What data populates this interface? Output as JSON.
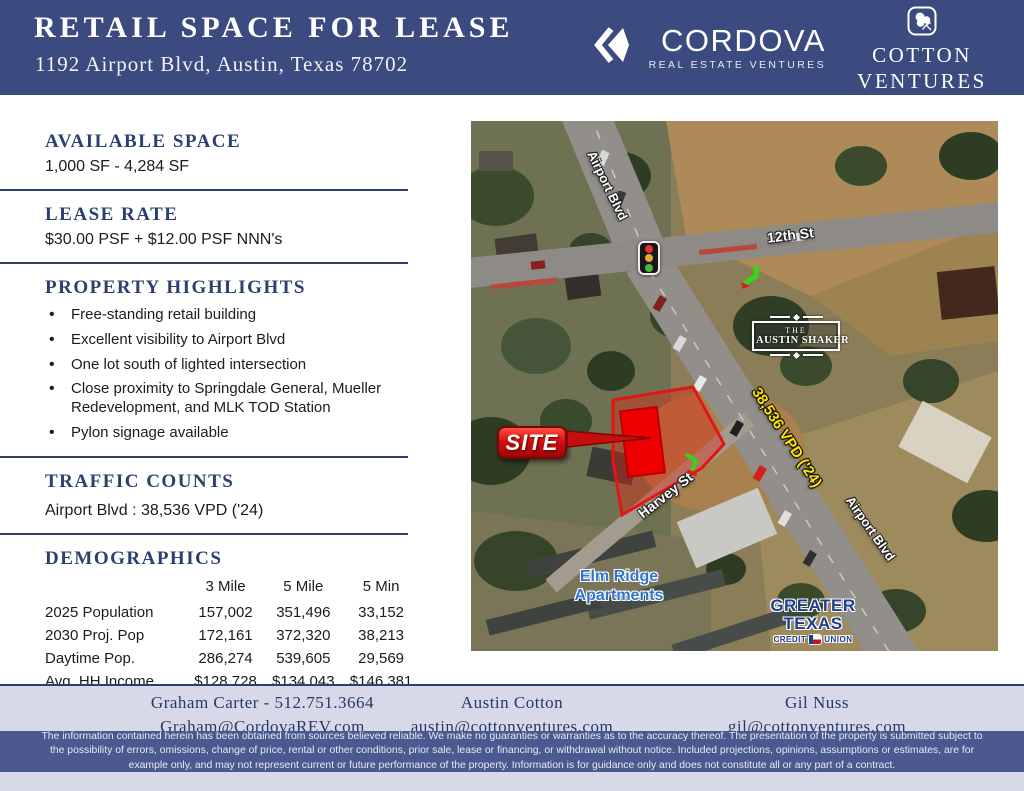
{
  "header": {
    "title": "RETAIL SPACE FOR LEASE",
    "subtitle": "1192 Airport Blvd, Austin, Texas 78702",
    "cordova_name": "CORDOVA",
    "cordova_tagline": "REAL ESTATE VENTURES",
    "cotton_line1": "COTTON",
    "cotton_line2": "VENTURES"
  },
  "colors": {
    "header_navy": "#3b4a7f",
    "accent_navy": "#2c406f",
    "band_lavender": "#d8d9e8",
    "disclaimer_navy": "#4c5890",
    "site_red": "#d61010",
    "vpd_yellow": "#ffe300"
  },
  "available_space": {
    "heading": "AVAILABLE SPACE",
    "value": "1,000 SF - 4,284 SF"
  },
  "lease_rate": {
    "heading": "LEASE RATE",
    "value": "$30.00 PSF + $12.00 PSF NNN's"
  },
  "highlights": {
    "heading": "PROPERTY HIGHLIGHTS",
    "items": [
      "Free-standing retail building",
      "Excellent visibility to Airport Blvd",
      "One lot south of lighted intersection",
      "Close proximity to Springdale General, Mueller Redevelopment, and MLK TOD Station",
      "Pylon signage available"
    ]
  },
  "traffic_counts": {
    "heading": "TRAFFIC COUNTS",
    "value": "Airport Blvd : 38,536 VPD ('24)"
  },
  "demographics": {
    "heading": "DEMOGRAPHICS",
    "columns": [
      "3 Mile",
      "5 Mile",
      "5 Min"
    ],
    "rows": [
      {
        "label": "2025 Population",
        "values": [
          "157,002",
          "351,496",
          "33,152"
        ]
      },
      {
        "label": "2030 Proj. Pop",
        "values": [
          "172,161",
          "372,320",
          "38,213"
        ]
      },
      {
        "label": "Daytime Pop.",
        "values": [
          "286,274",
          "539,605",
          "29,569"
        ]
      },
      {
        "label": "Avg. HH Income",
        "values": [
          "$128,728",
          "$134,043",
          "$146,381"
        ]
      }
    ]
  },
  "map": {
    "street_airport_top": "Airport Blvd",
    "street_12th": "12th St",
    "street_harvey": "Harvey St",
    "street_airport_bottom": "Airport Blvd",
    "site_label": "SITE",
    "vpd_label": "38,536 VPD ('24)",
    "shaker_the": "THE",
    "shaker_name": "AUSTIN SHAKER",
    "elm_line1": "Elm Ridge",
    "elm_line2": "Apartments",
    "gtcu_line1": "GREATER",
    "gtcu_line2": "TEXAS",
    "gtcu_credit": "CREDIT",
    "gtcu_union": "UNION"
  },
  "footer": {
    "contacts": [
      {
        "line1": "Graham Carter - 512.751.3664",
        "line2": "Graham@CordovaREV.com"
      },
      {
        "line1": "Austin Cotton",
        "line2": "austin@cottonventures.com"
      },
      {
        "line1": "Gil Nuss",
        "line2": "gil@cottonventures.com"
      }
    ],
    "disclaimer": "The information contained herein has been obtained from sources believed reliable. We make no guaranties or warranties as to the accuracy thereof. The presentation of the property is submitted subject to the possibility of errors, omissions, change of price, rental or other conditions, prior sale, lease or financing, or withdrawal without notice. Included projections, opinions, assumptions or estimates, are for example only, and may not represent current or future performance of the property. Information is for guidance only and does not constitute all or any part of a contract."
  }
}
